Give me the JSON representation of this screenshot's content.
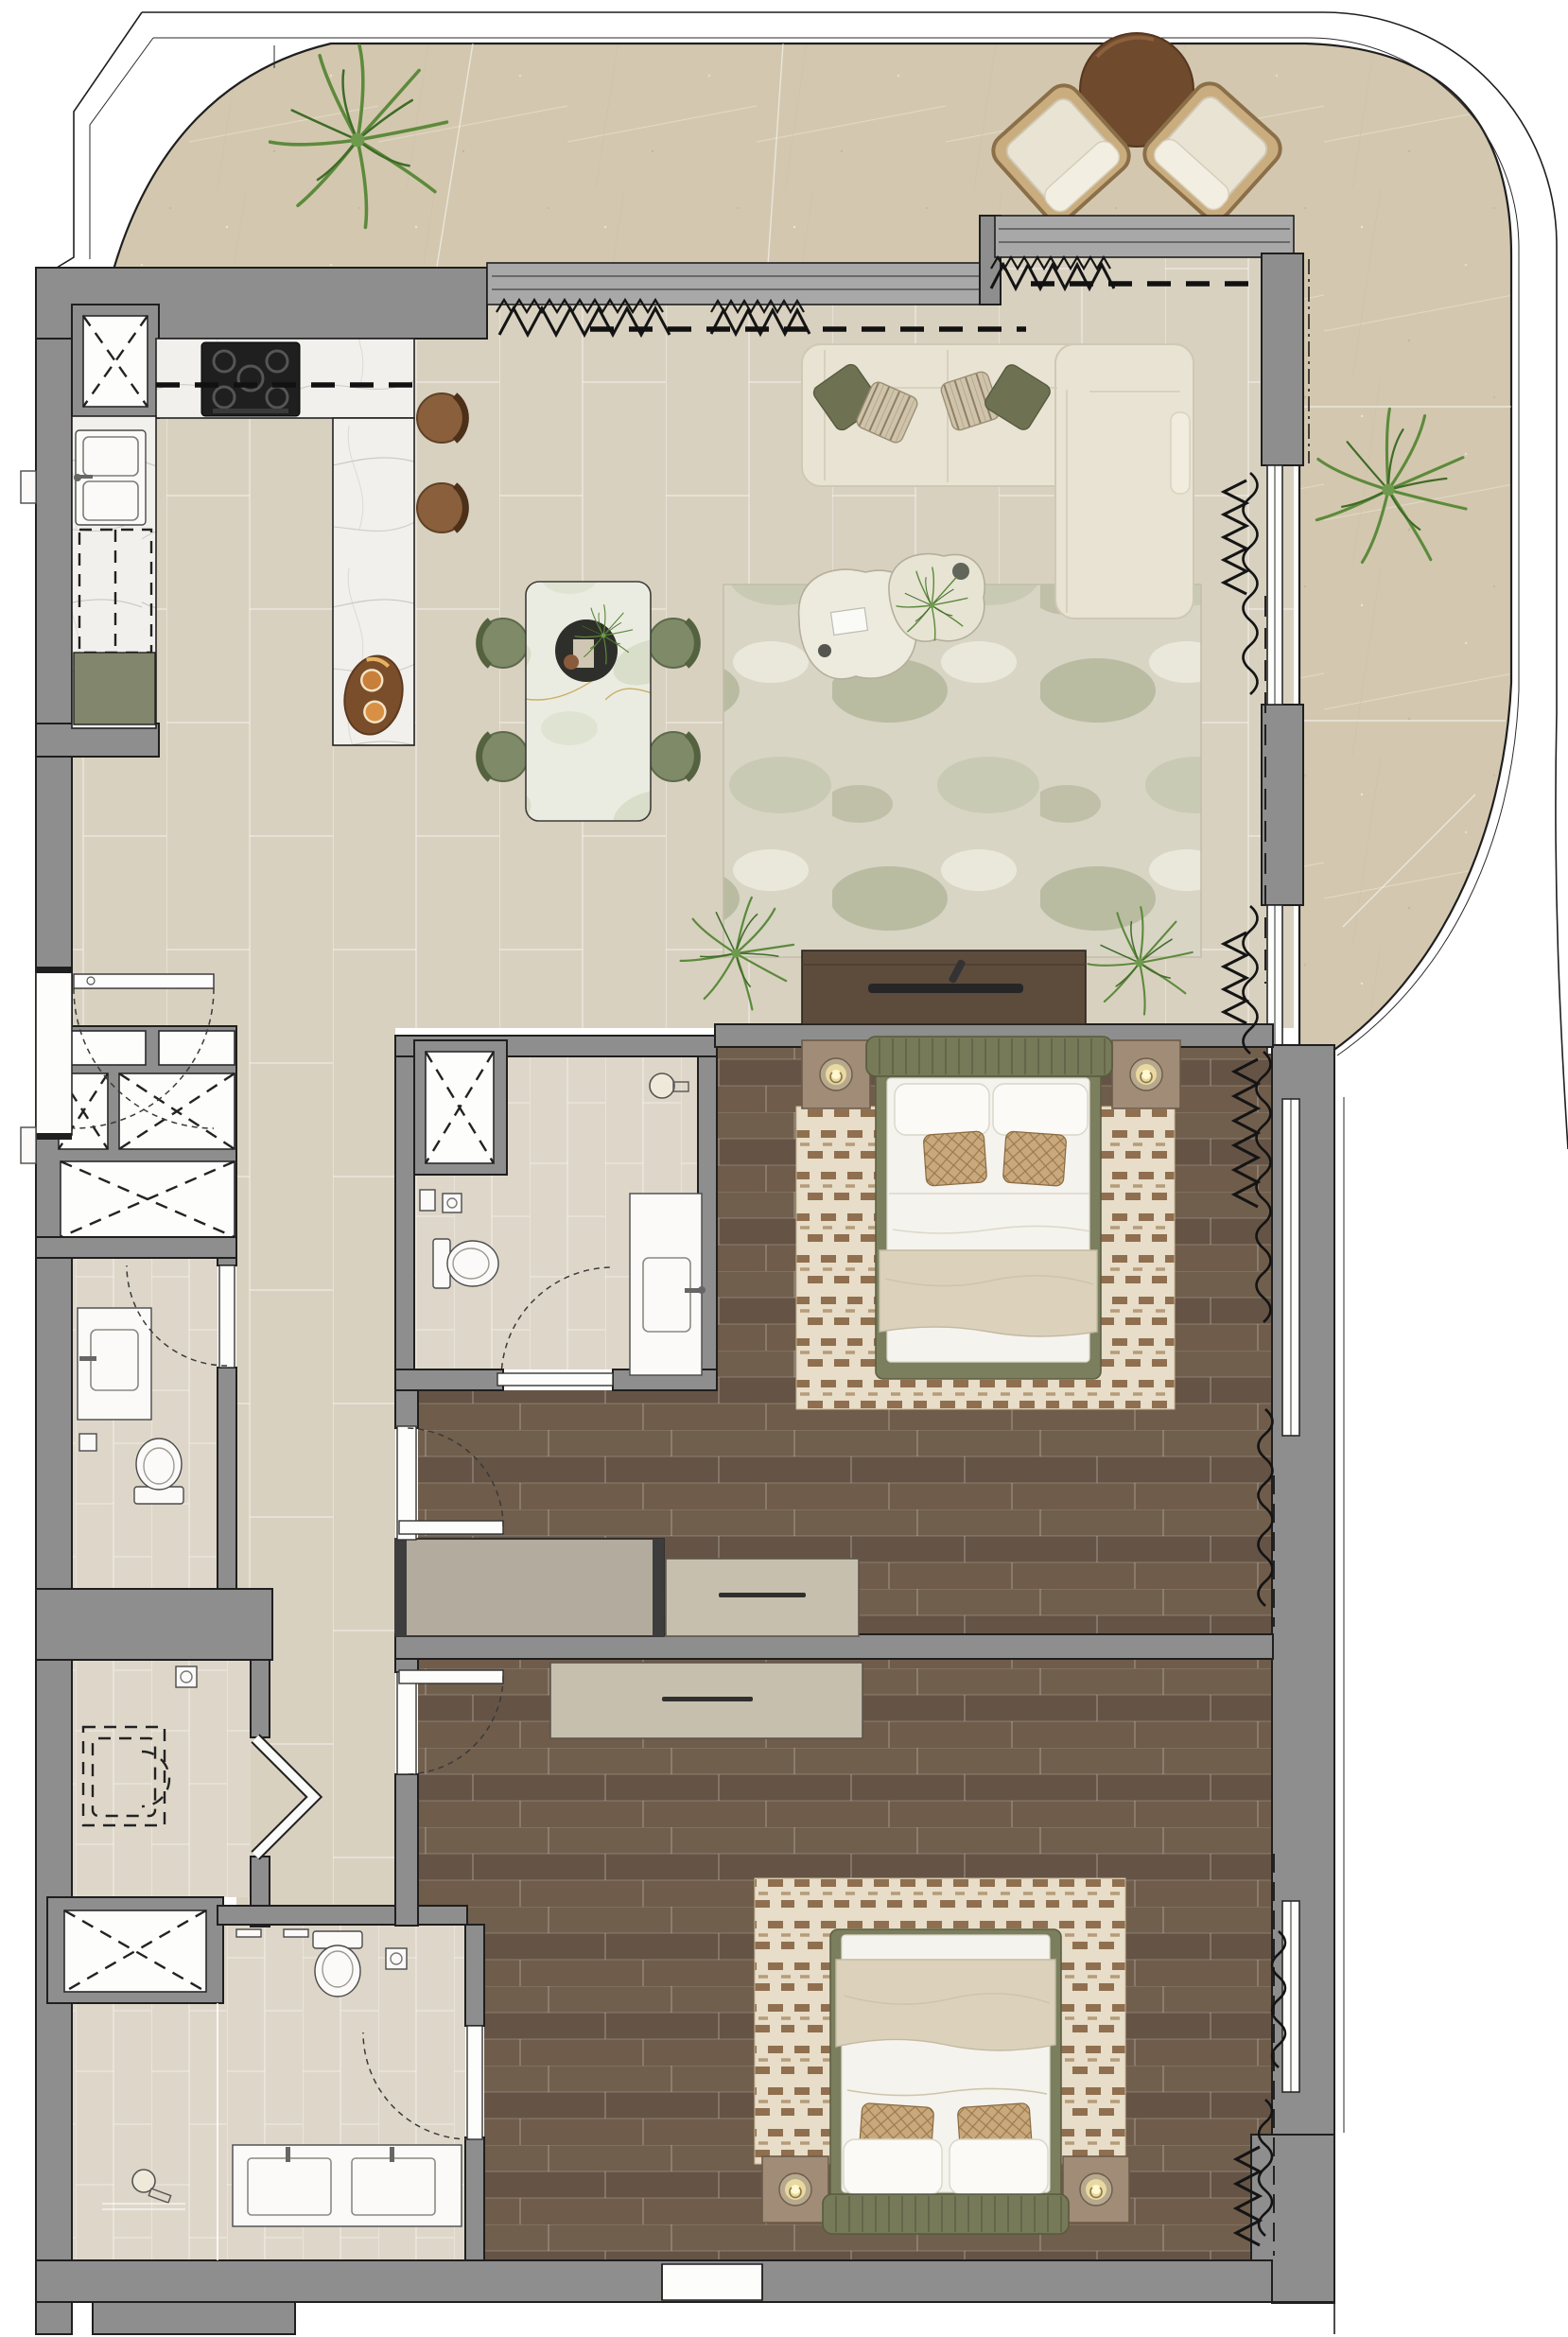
{
  "palette": {
    "wall": "#8e8e8e",
    "terrace": "#d3c8af",
    "tile": "#d9d1c0",
    "tileLight": "#ded7c9",
    "wood": "#6b5847",
    "marble": "#f1f0ec",
    "marbleGreen": "#ebece1",
    "olive": "#82866c",
    "oliveBed": "#7b7f5e",
    "cream": "#e9e3d3",
    "blanket": "#dcd2bc",
    "woodDark": "#5d4b3c",
    "tan": "#c7bfae",
    "taupe": "#a08c77",
    "brown": "#8a5f3c",
    "plant": "#5d8a3c",
    "rugBase": "#d8d5c5",
    "rugAccent": "#9aa37e",
    "rugBed": "#e7ddc8",
    "rugBedAccent": "#8f6f4f"
  },
  "floorplan": {
    "type": "residential-apartment-top-view",
    "terrace": {
      "items": [
        "palm-plant-top",
        "palm-plant-right",
        "lounge-chair-left",
        "lounge-chair-right",
        "round-side-table",
        "curved-parapet"
      ]
    },
    "rooms": [
      {
        "id": "kitchen",
        "items": [
          "l-shaped-marble-counter",
          "gas-hob",
          "double-sink",
          "dashed-appliance",
          "olive-base-cabinet",
          "marble-island",
          "serving-tray",
          "bar-stool-1",
          "bar-stool-2",
          "duct-shaft"
        ]
      },
      {
        "id": "living-dining",
        "items": [
          "dining-table",
          "dining-chair-x4",
          "centerpiece",
          "sectional-sofa",
          "throw-pillow-x4",
          "coffee-table-x2",
          "area-rug",
          "tv-console",
          "soundbar",
          "floor-plant",
          "sliding-glass-doors",
          "curtains"
        ]
      },
      {
        "id": "hallway",
        "items": [
          "entrance-door",
          "service-shafts",
          "tiled-floor"
        ]
      },
      {
        "id": "powder-room",
        "items": [
          "vanity-sink",
          "toilet"
        ]
      },
      {
        "id": "ensuite-bathroom",
        "items": [
          "duct-shaft",
          "toilet",
          "vanity-sink",
          "wall-lamp",
          "door"
        ]
      },
      {
        "id": "bedroom-1",
        "items": [
          "double-bed",
          "upholstered-headboard",
          "nightstand-x2",
          "table-lamp-x2",
          "area-rug",
          "wardrobe",
          "dresser",
          "window-curtains"
        ]
      },
      {
        "id": "laundry",
        "items": [
          "washing-machine-dashed",
          "folding-door",
          "ceiling-light",
          "duct-shaft"
        ]
      },
      {
        "id": "bathroom-2",
        "items": [
          "walk-in-shower",
          "shower-head",
          "toilet",
          "double-vanity",
          "door"
        ]
      },
      {
        "id": "bedroom-2",
        "items": [
          "double-bed",
          "upholstered-headboard",
          "nightstand-x2",
          "table-lamp-x2",
          "area-rug",
          "dresser",
          "window-curtains"
        ]
      }
    ]
  }
}
